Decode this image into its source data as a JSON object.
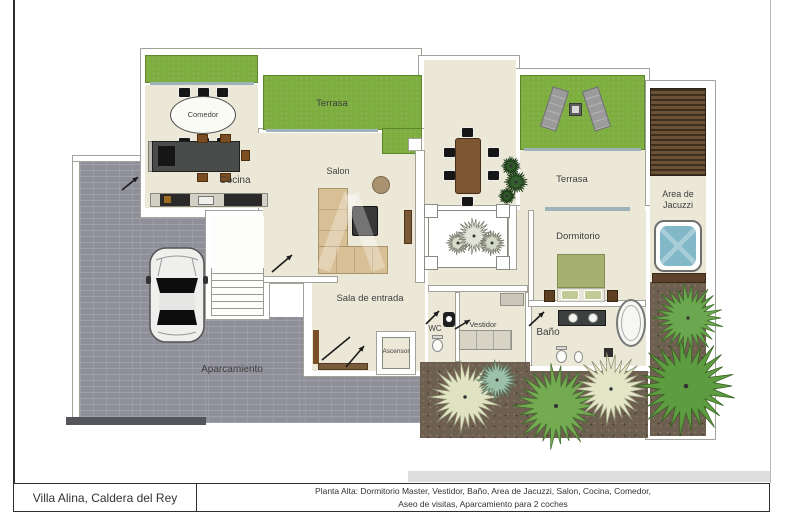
{
  "title_block": {
    "project_name": "Villa Alina, Caldera del Rey",
    "plan_description_line1": "Planta Alta: Dormitorio Master, Vestidor, Baño, Area de Jacuzzi, Salon, Cocina, Comedor,",
    "plan_description_line2": "Aseo de visitas, Aparcamiento para 2 coches"
  },
  "room_labels": {
    "comedor": "Comedor",
    "terraza_top": "Terrasa",
    "cocina": "Cocina",
    "salon": "Salon",
    "terraza_right": "Terrasa",
    "area_jacuzzi_line1": "Area de",
    "area_jacuzzi_line2": "Jacuzzi",
    "dormitorio": "Dormitorio",
    "sala_de_entrada": "Sala de entrada",
    "wc": "WC",
    "vestidor": "Vestidor",
    "bano": "Baño",
    "ascensor": "Ascensor",
    "aparcamiento": "Aparcamiento"
  },
  "colors": {
    "grass": "#7dae3f",
    "floor": "#ece8d8",
    "parking_paving": "#8f8f99",
    "deck_wood": "#5a452c",
    "jacuzzi_water": "#82b7c8",
    "garden_soil": "#6e6050",
    "sofa": "#d8bf95",
    "bed_cover": "#a6b070",
    "kitchen_island": "#4a4c4b",
    "wall_outline": "#a2a29a"
  }
}
